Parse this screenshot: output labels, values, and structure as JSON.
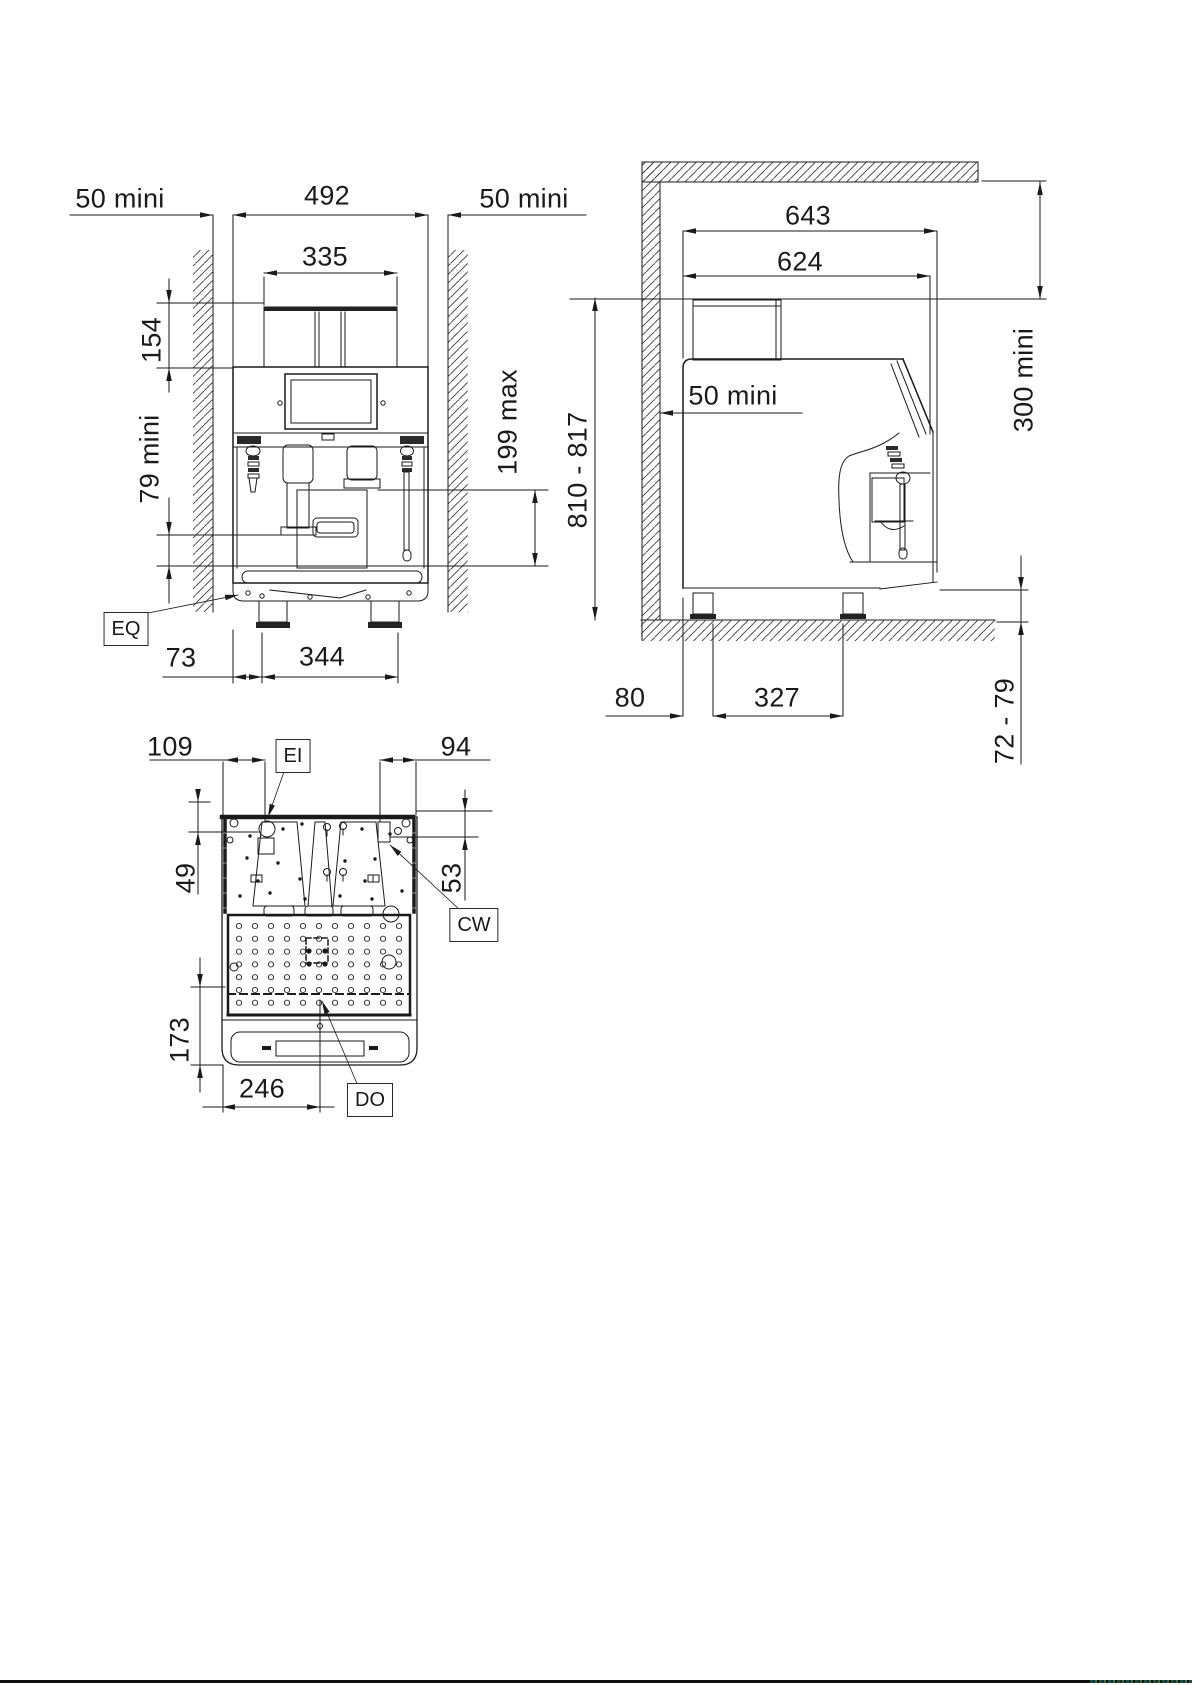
{
  "front_view": {
    "clearance_left": "50 mini",
    "overall_width": "492",
    "clearance_right": "50 mini",
    "hopper_width": "335",
    "hopper_height": "154",
    "cup_clearance": "79 mini",
    "spout_max_height": "199 max",
    "eq_label": "EQ",
    "foot_offset": "73",
    "foot_spacing": "344"
  },
  "side_view": {
    "overall_depth": "643",
    "body_depth": "624",
    "rear_clearance": "50 mini",
    "overall_height": "810 - 817",
    "top_clearance": "300 mini",
    "foot_rear_offset": "80",
    "foot_spacing": "327",
    "base_height": "72 - 79"
  },
  "bottom_view": {
    "ei_offset": "109",
    "ei_label": "EI",
    "cw_offset": "94",
    "ei_depth": "49",
    "cw_depth": "53",
    "cw_label": "CW",
    "tray_depth": "173",
    "do_offset": "246",
    "do_label": "DO"
  }
}
